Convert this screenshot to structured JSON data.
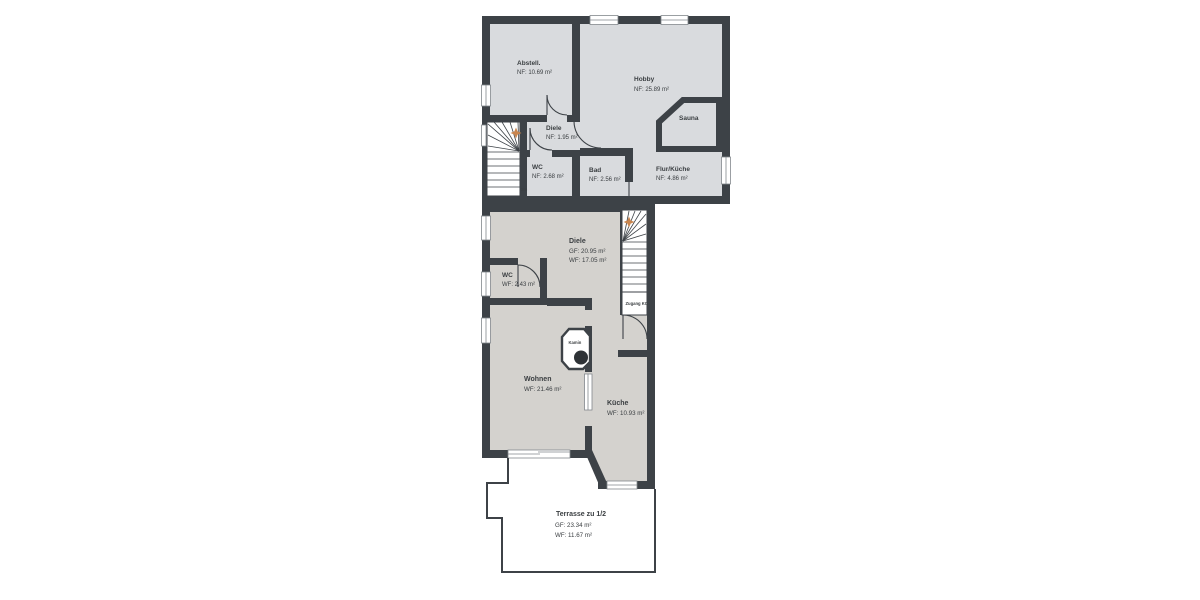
{
  "title": "Floor plan",
  "colors": {
    "wall": "#3d4247",
    "room_upper": "#d9dbde",
    "room_lower": "#d4d2ce",
    "stair_marker": "#c9854e",
    "text": "#3a3e41"
  },
  "basement": {
    "abstell": {
      "name": "Abstell.",
      "area": "NF: 10.69 m²"
    },
    "hobby": {
      "name": "Hobby",
      "area": "NF: 25.89 m²"
    },
    "sauna": {
      "name": "Sauna"
    },
    "diele": {
      "name": "Diele",
      "area": "NF: 1.95 m²"
    },
    "wc": {
      "name": "WC",
      "area": "NF: 2.68 m²"
    },
    "bad": {
      "name": "Bad",
      "area": "NF: 2.56 m²"
    },
    "flur_kueche": {
      "name": "Flur/Küche",
      "area": "NF: 4.86 m²"
    },
    "stair_width_note": "2m"
  },
  "ground": {
    "diele": {
      "name": "Diele",
      "gf": "GF: 20.95 m²",
      "wf": "WF: 17.05 m²"
    },
    "wc": {
      "name": "WC",
      "wf": "WF: 2.43 m²"
    },
    "wohnen": {
      "name": "Wohnen",
      "wf": "WF: 21.46 m²"
    },
    "kueche": {
      "name": "Küche",
      "wf": "WF: 10.93 m²"
    },
    "kamin": {
      "name": "Kamin"
    },
    "zugang": {
      "name": "Zugang KG"
    },
    "terrasse": {
      "name": "Terrasse zu 1/2",
      "gf": "GF: 23.34 m²",
      "wf": "WF: 11.67 m²"
    }
  }
}
